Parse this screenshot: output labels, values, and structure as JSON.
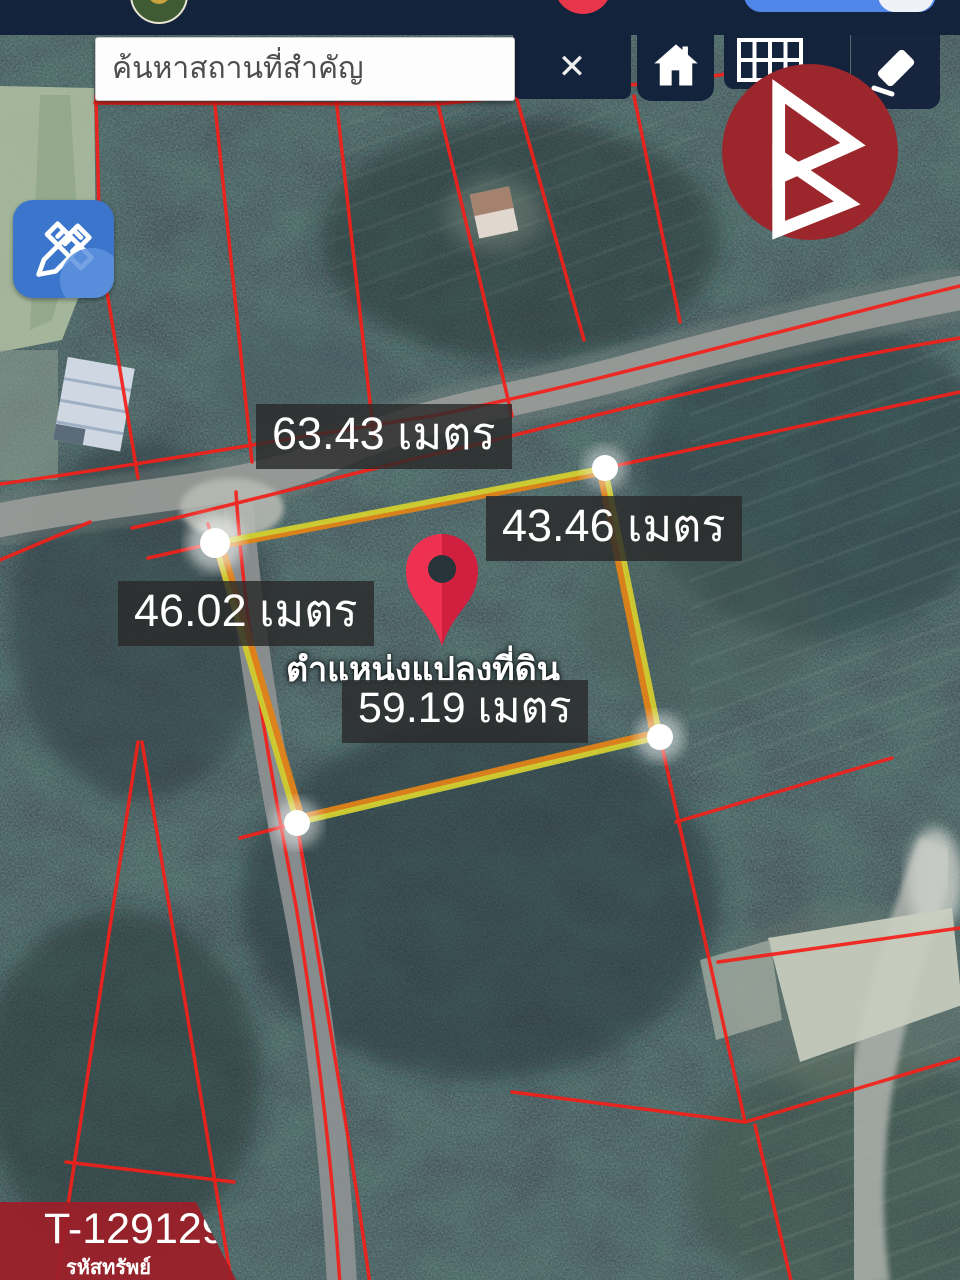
{
  "topbar": {
    "search_placeholder": "ค้นหาสถานที่สำคัญ",
    "clear_label": "✕"
  },
  "map": {
    "measurements": [
      {
        "name": "top-edge",
        "label": "63.43 เมตร"
      },
      {
        "name": "right-edge",
        "label": "43.46 เมตร"
      },
      {
        "name": "left-edge",
        "label": "46.02 เมตร"
      },
      {
        "name": "bottom-edge",
        "label": "59.19 เมตร"
      }
    ],
    "pin_caption": "ตำแหน่งแปลงที่ดิน"
  },
  "badge": {
    "code": "T-129129",
    "caption": "รหัสทรัพย์"
  },
  "icons": {
    "close": "close-icon",
    "home": "home-icon",
    "grid": "parcel-grid-icon",
    "eraser": "eraser-icon",
    "edit": "measure-edit-icon",
    "brand": "brand-logo",
    "pin": "location-pin"
  },
  "colors": {
    "topbar_bg": "#14233c",
    "parcel_line": "#f3201a",
    "measure_line": "#cbd034",
    "measure_underlay": "#e08318",
    "pin_red": "#e62e4d",
    "vertex_handle": "#ffffff",
    "label_bg": "rgba(42,42,42,0.82)",
    "badge_bg": "#9b1f28",
    "edit_button_blue": "#3b76cc",
    "brand_red": "#9b262c"
  }
}
